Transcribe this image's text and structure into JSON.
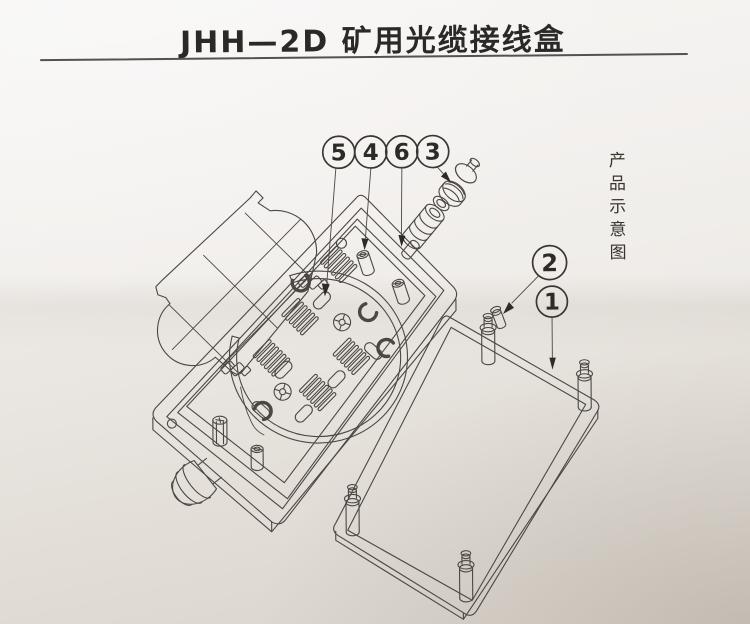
{
  "page": {
    "title": "JHH—2D 矿用光缆接线盒",
    "side_label": "产品示意图",
    "paper_color_top": "#f4f2f0",
    "paper_color_bottom": "#d8d2ca",
    "line_color": "#4b4742",
    "text_color": "#2b2927"
  },
  "callouts": [
    {
      "label": "5"
    },
    {
      "label": "4"
    },
    {
      "label": "6"
    },
    {
      "label": "3"
    },
    {
      "label": "2"
    },
    {
      "label": "1"
    }
  ]
}
